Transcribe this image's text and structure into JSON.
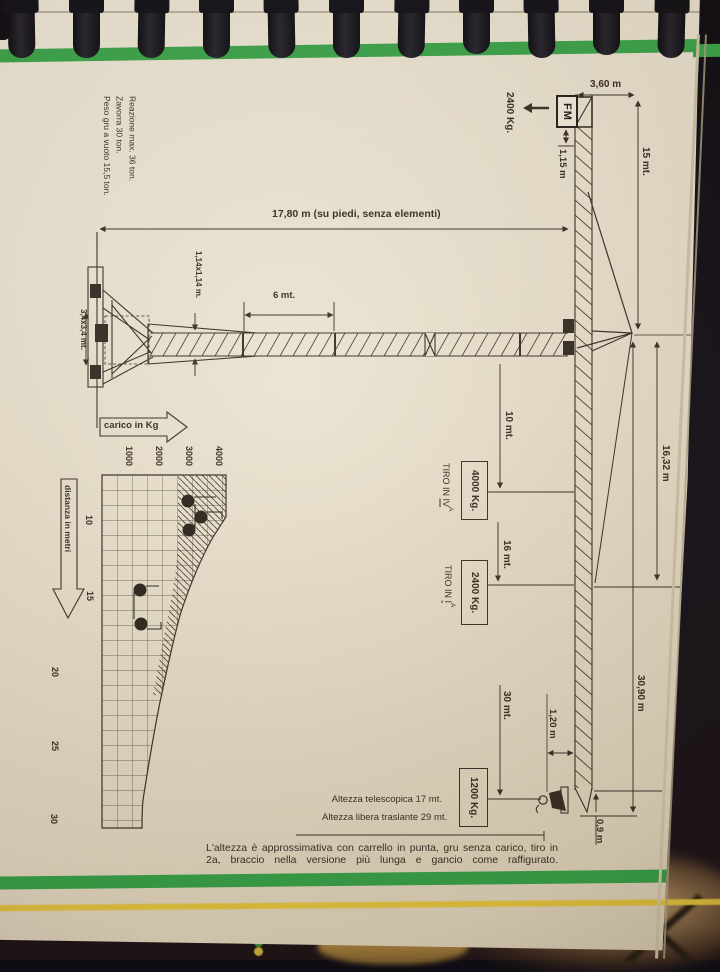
{
  "side_notes": {
    "line1": "Peso gru a vuoto 15,5 ton.",
    "line2": "Zavorra 30 ton.",
    "line3": "Reazione max. 36 ton."
  },
  "crane": {
    "brand": "FM",
    "counterweight_load": "2400 Kg.",
    "dim_counterjib": "3,60 m",
    "dim_head": "15 mt.",
    "dim_ballast_height": "1,15 m",
    "dim_tower": "17,80 m (su piedi, senza elementi)",
    "dim_section": "1,14x1,14 m.",
    "dim_element": "6 mt.",
    "dim_base": "3,4x3,4 mt.",
    "dim_tie": "16,32 m",
    "dim_jib_total": "30,90 m",
    "dim_trolley": "1,20 m",
    "dim_tip": "0,9 m",
    "radius_1": "10 mt.",
    "load_1": "4000 Kg.",
    "radius_2": "16 mt.",
    "load_2": "2400 Kg.",
    "radius_3": "30 mt.",
    "load_3": "1200 Kg.",
    "tiro_prefix": "TIRO IN",
    "tiro_1": "IV",
    "tiro_1_sup": "A",
    "tiro_2": "I",
    "tiro_2_sup": "A"
  },
  "chart": {
    "xlabel": "carico in Kg",
    "ylabel": "distanza in metri",
    "xtick_1": "1000",
    "xtick_2": "2000",
    "xtick_3": "3000",
    "xtick_4": "4000",
    "ytick_1": "10",
    "ytick_2": "15",
    "ytick_3": "20",
    "ytick_4": "25",
    "ytick_5": "30"
  },
  "chart_data": {
    "type": "area",
    "title": "Diagramma di carico gru",
    "xlabel": "carico in Kg",
    "ylabel": "distanza in metri",
    "xlim": [
      0,
      4200
    ],
    "ylim": [
      7,
      30
    ],
    "x_ticks": [
      1000,
      2000,
      3000,
      4000
    ],
    "y_ticks": [
      10,
      15,
      20,
      25,
      30
    ],
    "grid": true,
    "legend": false,
    "curve_points": [
      {
        "distanza_m": 7,
        "carico_kg": 4200
      },
      {
        "distanza_m": 10,
        "carico_kg": 4150
      },
      {
        "distanza_m": 12,
        "carico_kg": 3450
      },
      {
        "distanza_m": 15,
        "carico_kg": 2750
      },
      {
        "distanza_m": 20,
        "carico_kg": 1950
      },
      {
        "distanza_m": 25,
        "carico_kg": 1500
      },
      {
        "distanza_m": 30,
        "carico_kg": 1320
      }
    ],
    "rated_points": [
      {
        "carico_kg": 4000,
        "distanza_m": 10,
        "tiro": "IVa"
      },
      {
        "carico_kg": 2400,
        "distanza_m": 16,
        "tiro": "Ia"
      },
      {
        "carico_kg": 1200,
        "distanza_m": 30,
        "tiro": ""
      }
    ],
    "marker_dots": [
      {
        "carico_kg": 2870,
        "distanza_m": 8.7
      },
      {
        "carico_kg": 3300,
        "distanza_m": 9.7
      },
      {
        "carico_kg": 2900,
        "distanza_m": 10.6
      },
      {
        "carico_kg": 1270,
        "distanza_m": 14.5
      },
      {
        "carico_kg": 1300,
        "distanza_m": 16.8
      }
    ]
  },
  "footer": {
    "note_1": "Altezza telescopica 17 mt.",
    "note_2": "Altezza libera traslante 29 mt.",
    "caption": "L'altezza è approssimativa con carrello in punta, gru senza carico, tiro in 2a, braccio nella versione più lunga e gancio come raffigurato."
  }
}
